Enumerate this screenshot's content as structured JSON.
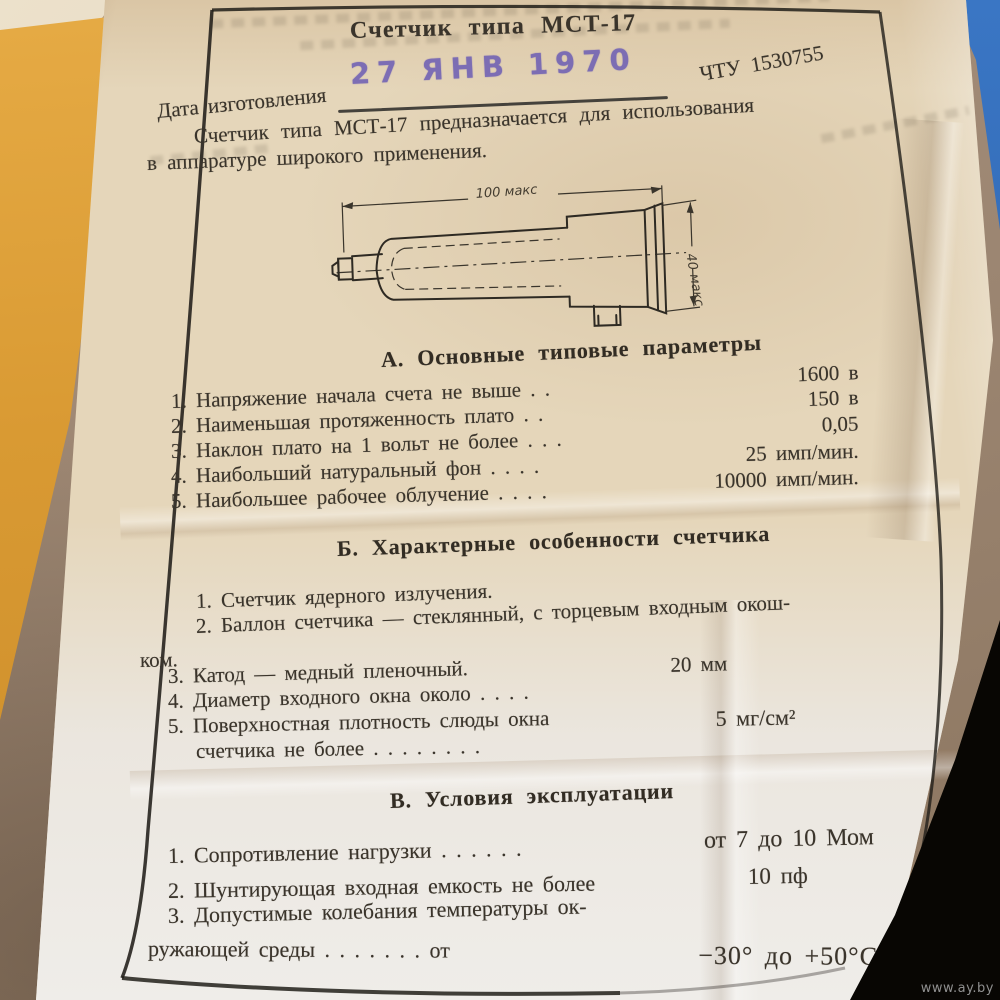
{
  "photo": {
    "watermark": "www.ay.by",
    "colors": {
      "stamp_ink": "#6f60b4",
      "paper": "#e5d6ba",
      "frame_ink": "#211e19",
      "orange_surface": "#d99a33",
      "blue_surface": "#3a76c4"
    }
  },
  "document": {
    "title": "Счетчик типа МСТ-17",
    "stamp_date": "27 ЯНВ 1970",
    "spec_number": "ЧТУ 1530755",
    "date_label": "Дата изготовления",
    "intro_line1": "Счетчик типа МСТ-17 предназначается для использования",
    "intro_line2": "в аппаратуре широкого применения.",
    "drawing": {
      "dim_length": "100 макс",
      "dim_diameter": "40 макс"
    },
    "section_a": {
      "heading": "А. Основные типовые параметры",
      "items": [
        {
          "label": "1. Напряжение начала счета не выше . .",
          "value": "1600 в"
        },
        {
          "label": "2. Наименьшая протяженность плато . .",
          "value": "150 в"
        },
        {
          "label": "3. Наклон плато на 1 вольт не более . . .",
          "value": "0,05"
        },
        {
          "label": "4. Наибольший натуральный фон . . . .",
          "value": "25 имп/мин."
        },
        {
          "label": "5. Наибольшее рабочее облучение . . . .",
          "value": "10000 имп/мин."
        }
      ]
    },
    "section_b": {
      "heading": "Б. Характерные особенности счетчика",
      "items": [
        {
          "label": "1. Счетчик ядерного излучения.",
          "value": ""
        },
        {
          "label": "2. Баллон счетчика — стеклянный, с торцевым входным окош-",
          "value": ""
        },
        {
          "label": "ком.",
          "value": ""
        },
        {
          "label": "3. Катод — медный пленочный.",
          "value": ""
        },
        {
          "label": "4. Диаметр входного окна около . . . .",
          "value": "20 мм"
        },
        {
          "label": "5. Поверхностная плотность слюды окна",
          "value": ""
        },
        {
          "label": "счетчика не более . . . . . . . .",
          "value": "5 мг/см²"
        }
      ]
    },
    "section_v": {
      "heading": "В. Условия эксплуатации",
      "items": [
        {
          "label": "1. Сопротивление нагрузки . . . . . .",
          "value": "от 7 до 10 Мом"
        },
        {
          "label": "2. Шунтирующая входная емкость не более",
          "value": "10 пф"
        },
        {
          "label": "3. Допустимые колебания температуры ок-",
          "value": ""
        },
        {
          "label": "ружающей среды . . . . . . . от",
          "value": "−30° до +50°С"
        }
      ]
    }
  }
}
